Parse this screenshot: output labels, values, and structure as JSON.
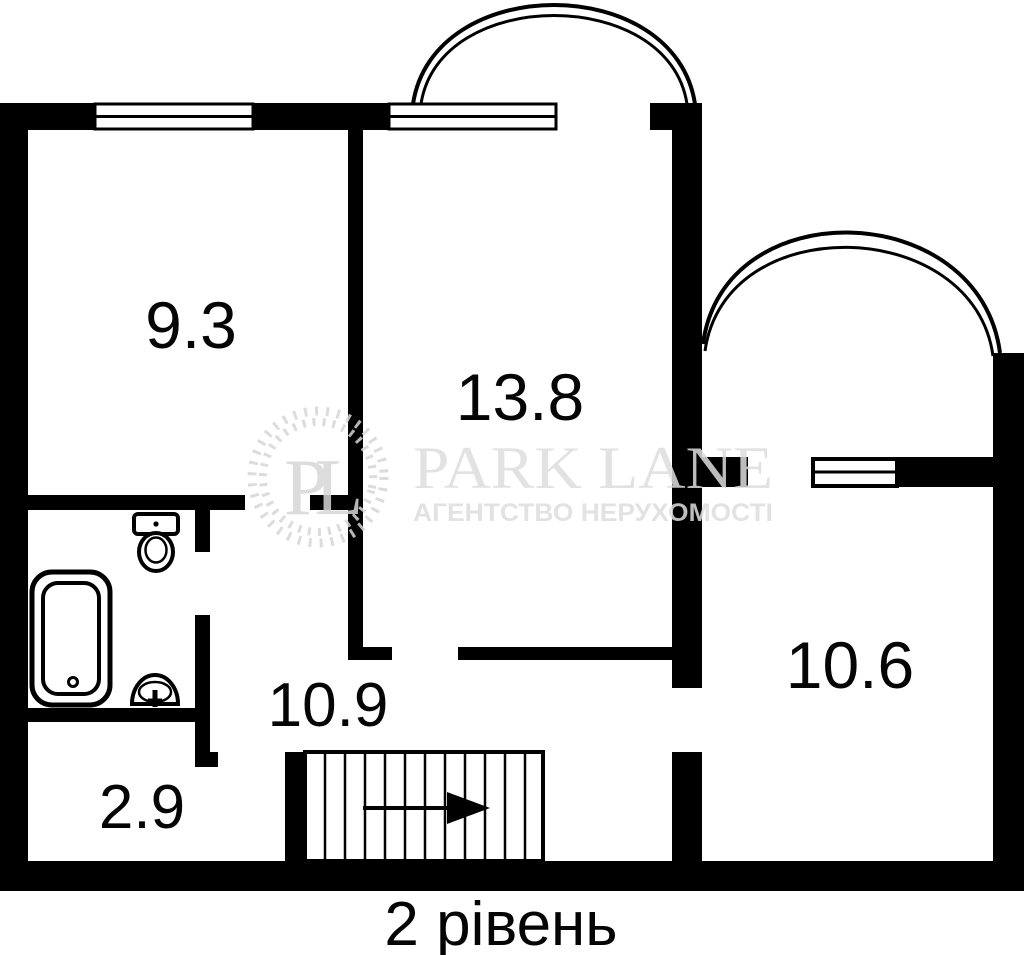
{
  "title": "2 рівень",
  "rooms": [
    {
      "name": "room-top-left",
      "area": "9.3"
    },
    {
      "name": "room-top-middle",
      "area": "13.8"
    },
    {
      "name": "room-right",
      "area": "10.6"
    },
    {
      "name": "hallway",
      "area": "10.9"
    },
    {
      "name": "room-bottom-left",
      "area": "2.9"
    }
  ],
  "watermark": {
    "monogram": "PL",
    "brand": "PARK LANE",
    "tagline": "АГЕНТСТВО НЕРУХОМОСТІ"
  },
  "fixtures": [
    "toilet",
    "bathtub",
    "sink",
    "staircase",
    "direction-arrow-right",
    "balcony-arc-top",
    "balcony-arc-right"
  ],
  "windows_count": 3,
  "colors": {
    "walls": "#000000",
    "background": "#ffffff",
    "watermark": "#d6d6d6",
    "labels": "#050505"
  }
}
